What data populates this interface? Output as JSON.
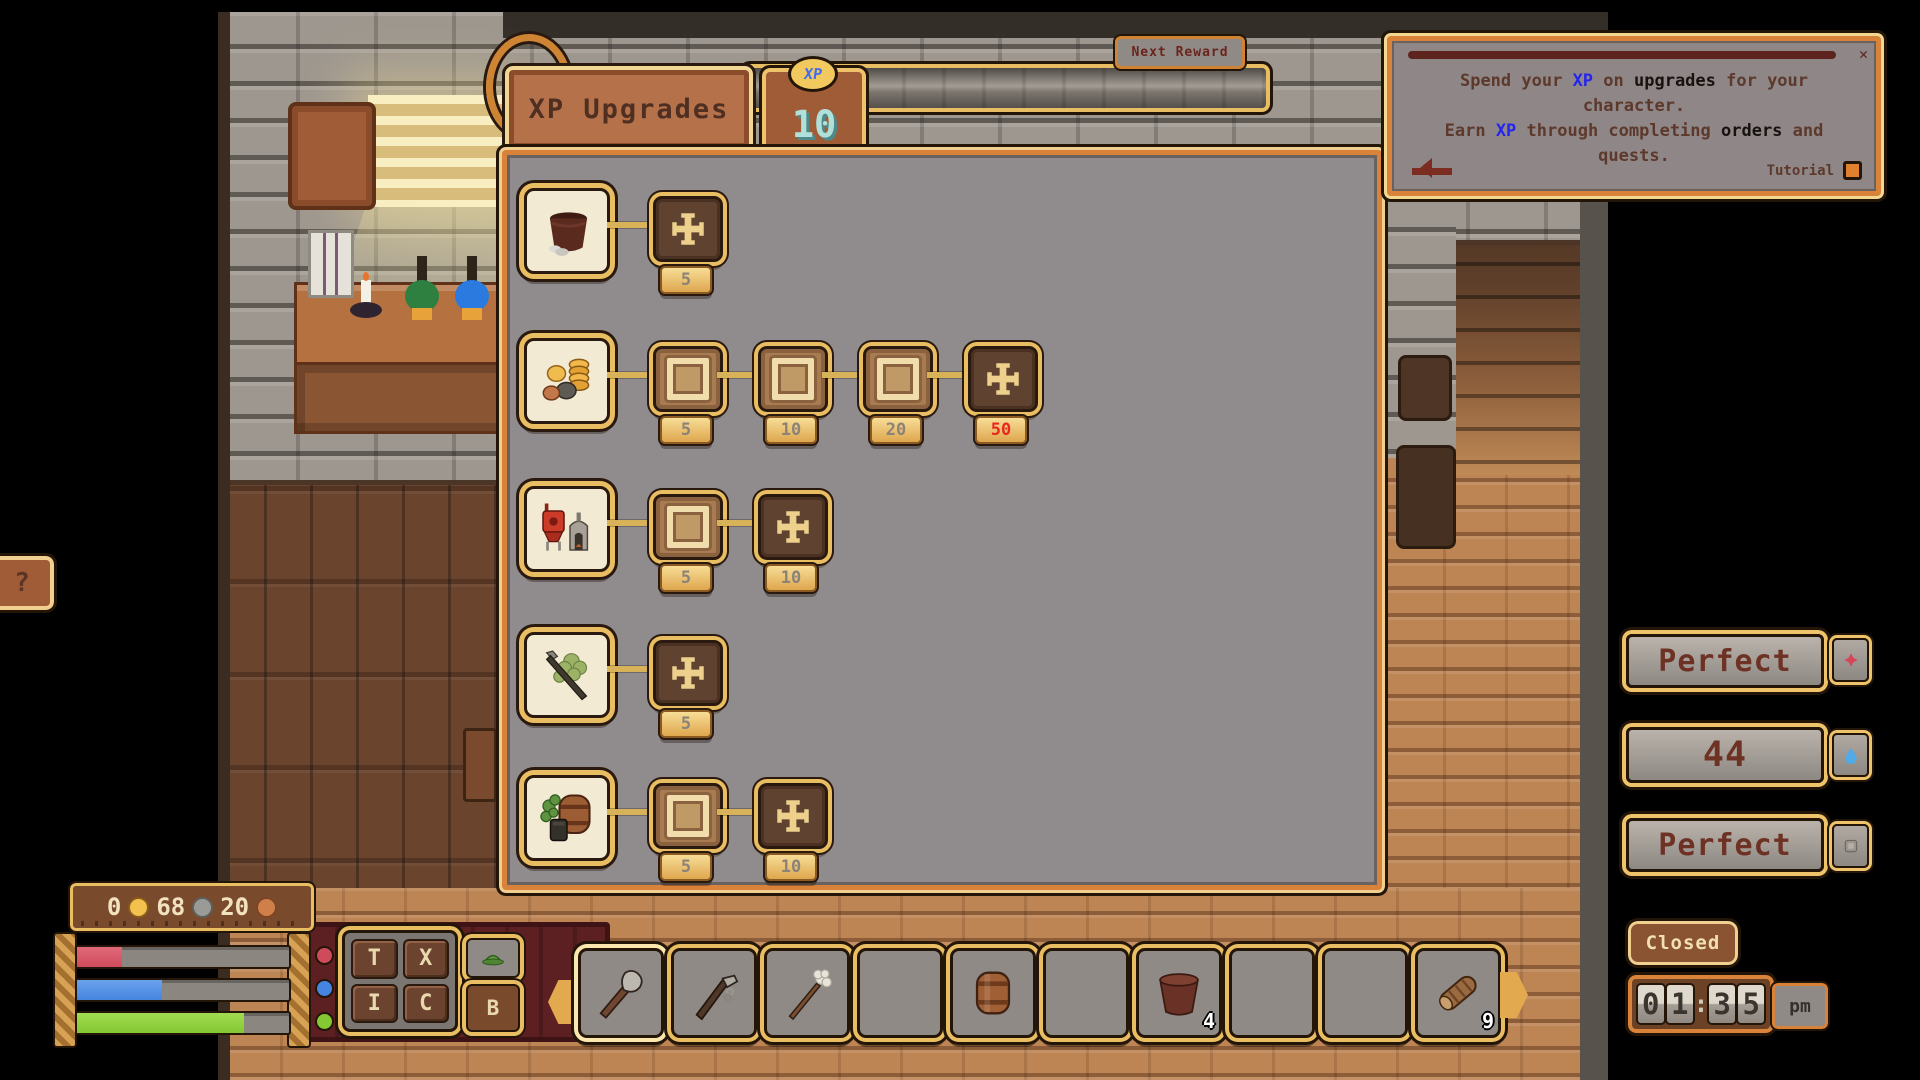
{
  "xp_panel": {
    "tab": "XP Upgrades",
    "coin_label": "XP",
    "xp_amount": "10",
    "next_reward": "Next Reward",
    "accent_gold": "#e9bd62",
    "rows": [
      {
        "icon": "cooking-pot",
        "nodes": [
          {
            "state": "locked",
            "cost": "5"
          }
        ]
      },
      {
        "icon": "coins",
        "nodes": [
          {
            "state": "owned",
            "cost": "5"
          },
          {
            "state": "owned",
            "cost": "10"
          },
          {
            "state": "owned",
            "cost": "20"
          },
          {
            "state": "locked",
            "cost": "50",
            "alert": true
          }
        ]
      },
      {
        "icon": "brewing",
        "nodes": [
          {
            "state": "owned",
            "cost": "5"
          },
          {
            "state": "locked",
            "cost": "10"
          }
        ]
      },
      {
        "icon": "farming",
        "nodes": [
          {
            "state": "locked",
            "cost": "5"
          }
        ]
      },
      {
        "icon": "barrel-hops",
        "nodes": [
          {
            "state": "owned",
            "cost": "5"
          },
          {
            "state": "locked",
            "cost": "10"
          }
        ]
      }
    ]
  },
  "tutorial": {
    "close": "✕",
    "r1a": "Spend your ",
    "r1b": "XP",
    "r1c": " on ",
    "r1d": "upgrades",
    "r1e": " for your",
    "r2": "character.",
    "r3a": "Earn ",
    "r3b": "XP",
    "r3c": " through completing ",
    "r3d": "orders",
    "r3e": " and",
    "r4": "quests.",
    "label": "Tutorial",
    "xp_color": "#2424f0"
  },
  "status": {
    "temperature": "Perfect",
    "water": "44",
    "cleanliness": "Perfect",
    "shop_state": "Closed",
    "clock": {
      "d1": "0",
      "d2": "1",
      "sep": ":",
      "d3": "3",
      "d4": "5",
      "meridiem": "pm"
    }
  },
  "wallet": {
    "gold": "0",
    "silver": "68",
    "copper": "20",
    "gold_color": "#f2c14e",
    "silver_color": "#9a9a96",
    "copper_color": "#cf7f4a"
  },
  "menu_grid": {
    "t": "T",
    "x": "X",
    "i": "I",
    "c": "C",
    "b": "B"
  },
  "help": {
    "label": "?"
  },
  "hotbar": {
    "slots": [
      {
        "item": "shovel",
        "qty": "",
        "selected": true
      },
      {
        "item": "hoe",
        "qty": ""
      },
      {
        "item": "mop",
        "qty": ""
      },
      {
        "item": "",
        "qty": ""
      },
      {
        "item": "barrel",
        "qty": ""
      },
      {
        "item": "",
        "qty": ""
      },
      {
        "item": "pot",
        "qty": "4"
      },
      {
        "item": "",
        "qty": ""
      },
      {
        "item": "",
        "qty": ""
      },
      {
        "item": "log",
        "qty": "9"
      }
    ]
  },
  "bars": {
    "health_pct": 21,
    "health_color": "#cf4b5b",
    "energy_pct": 40,
    "energy_color": "#4585e0",
    "stamina_pct": 79,
    "stamina_color": "#84c832"
  }
}
